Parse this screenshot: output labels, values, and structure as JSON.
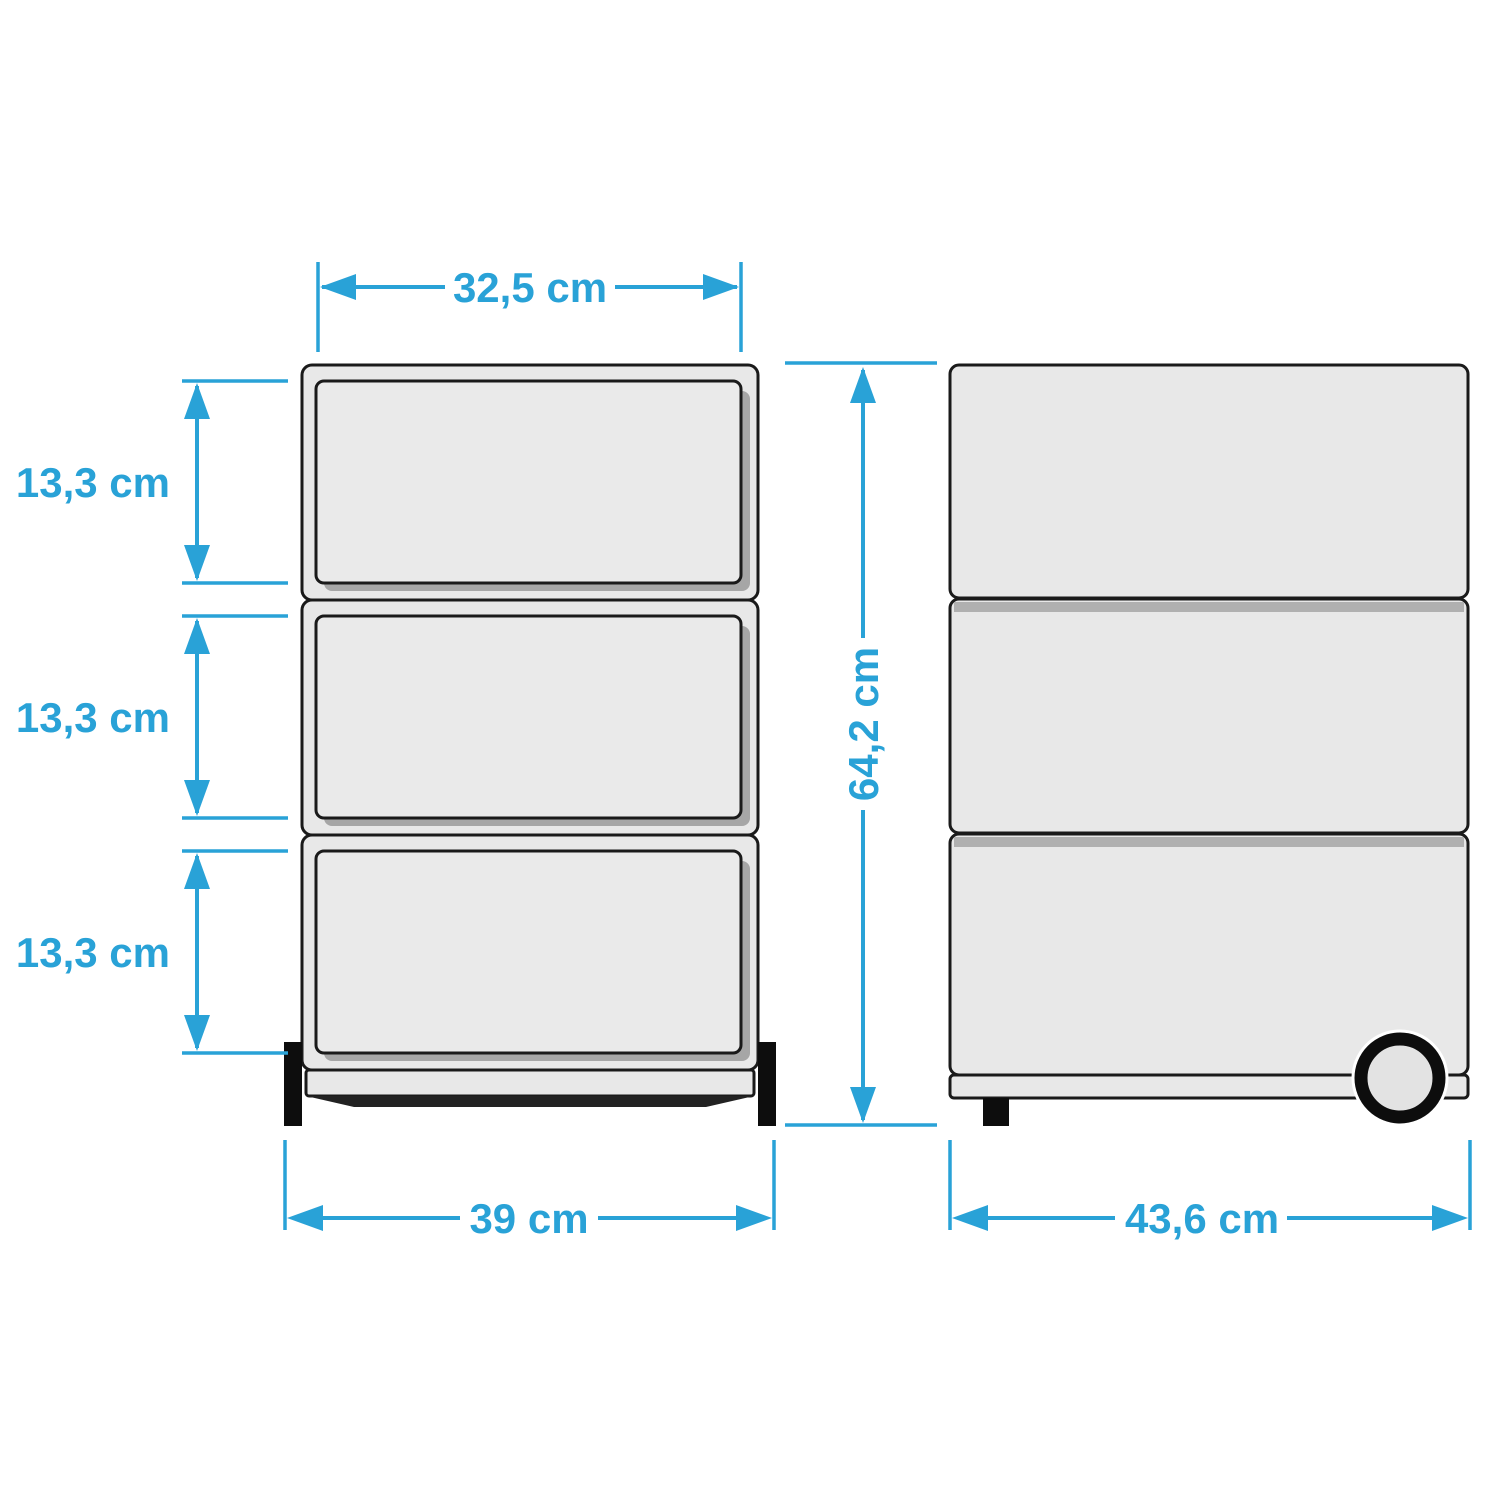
{
  "colors": {
    "accent": "#29a2d7",
    "outline": "#1a1a1a",
    "body_fill": "#e8e8e8",
    "drawer_fill": "#eaeaea",
    "shadow_fill": "#a6a6a6",
    "divider_fill": "#b0b0b0",
    "feet_fill": "#0d0d0d",
    "background": "#ffffff"
  },
  "front_view": {
    "drawer_count": 3,
    "dim_drawer_width": "32,5 cm",
    "dim_drawer_heights": [
      "13,3 cm",
      "13,3 cm",
      "13,3 cm"
    ],
    "dim_overall_width": "39 cm"
  },
  "side_view": {
    "section_count": 3,
    "dim_overall_height": "64,2 cm",
    "dim_overall_depth": "43,6 cm"
  }
}
